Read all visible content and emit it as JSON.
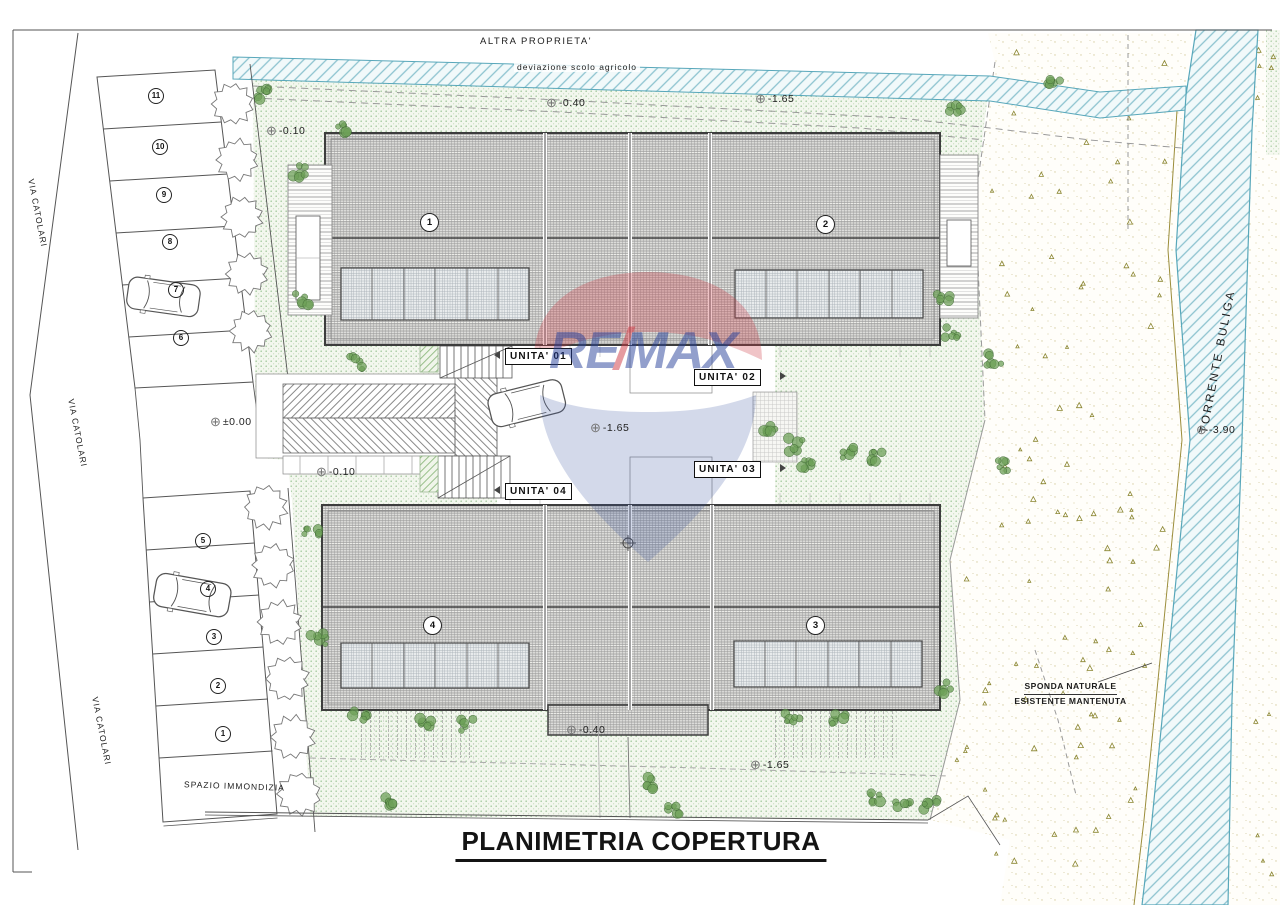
{
  "page": {
    "title": "PLANIMETRIA COPERTURA"
  },
  "labels": {
    "altra_proprieta": "ALTRA PROPRIETA'",
    "deviazione_scolo": "deviazione scolo agricolo",
    "via_catolari": "VIA CATOLARI",
    "torrente_buliga": "TORRENTE BULIGA",
    "sponda_line1": "SPONDA NATURALE",
    "sponda_line2": "ESISTENTE MANTENUTA",
    "spazio_immondizia": "SPAZIO IMMONDIZIA"
  },
  "units": [
    {
      "label": "UNITA' 01"
    },
    {
      "label": "UNITA' 02"
    },
    {
      "label": "UNITA' 03"
    },
    {
      "label": "UNITA' 04"
    }
  ],
  "building_numbers": [
    "1",
    "2",
    "3",
    "4"
  ],
  "parking_top": [
    "11",
    "10",
    "9",
    "8",
    "7",
    "6"
  ],
  "parking_bottom": [
    "5",
    "4",
    "3",
    "2",
    "1"
  ],
  "elevations": [
    "-0.10",
    "-0.40",
    "-1.65",
    "±0.00",
    "-0.10",
    "-1.65",
    "-0.40",
    "-1.65",
    "-3.90"
  ],
  "watermark": {
    "re": "RE",
    "slash": "/",
    "max": "MAX"
  },
  "colors": {
    "remax_blue": "#27419b",
    "remax_red": "#cf3a44",
    "river_edge": "#58a7ba",
    "lawn_dot": "#a6cba0",
    "bank_triangle": "#8a8530",
    "roof_line": "#3d3d3d"
  }
}
